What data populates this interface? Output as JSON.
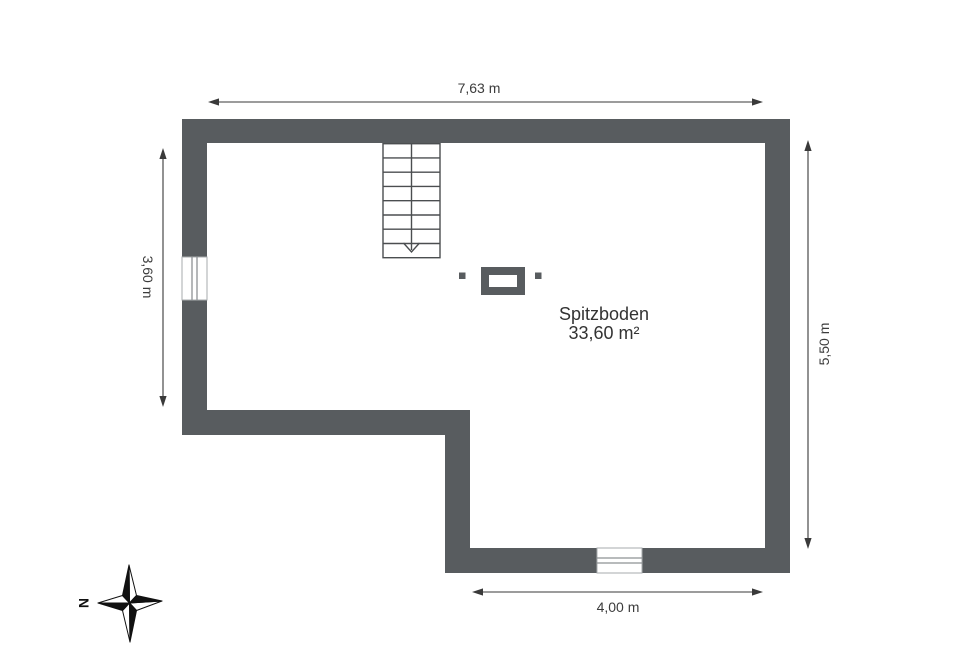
{
  "floorplan": {
    "room": {
      "name": "Spitzboden",
      "area": "33,60 m²"
    },
    "dimensions": {
      "top": {
        "label": "7,63 m"
      },
      "left": {
        "label": "3,60 m"
      },
      "right": {
        "label": "5,50 m"
      },
      "bottom": {
        "label": "4,00 m"
      }
    },
    "compass": {
      "north_label": "N"
    },
    "colors": {
      "wall": "#585c5f",
      "background": "#ffffff",
      "dimension_line": "#3a3a3a",
      "stair_line": "#4b4e50",
      "window_frame": "#8e9295",
      "text": "#3c3c3c",
      "compass_black": "#111111"
    }
  }
}
